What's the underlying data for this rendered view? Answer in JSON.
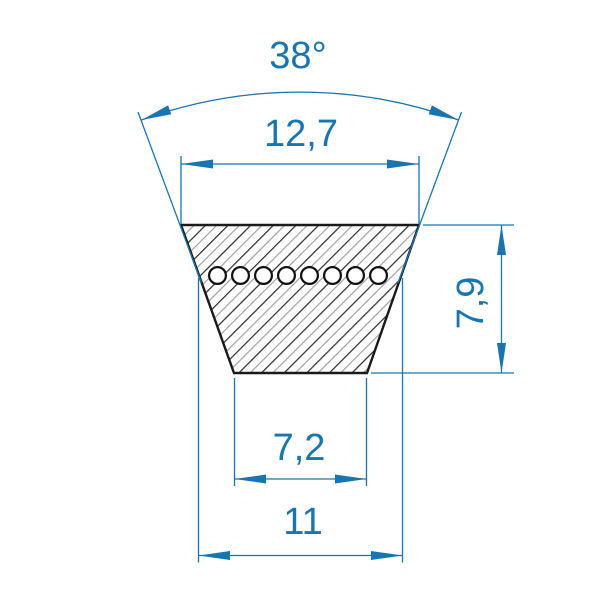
{
  "diagram": {
    "kind": "v-belt-cross-section",
    "labels": {
      "angle": "38°",
      "top_width": "12,7",
      "height": "7,9",
      "bottom_width": "7,2",
      "datum_width": "11"
    },
    "cord_circle_count": 8,
    "colors": {
      "dimension_blue": "#1776b1",
      "outline_black": "#1a1a1a",
      "hatch_dark": "#2a2a2a",
      "hatch_light": "#9a9a9a",
      "background": "#ffffff"
    }
  }
}
